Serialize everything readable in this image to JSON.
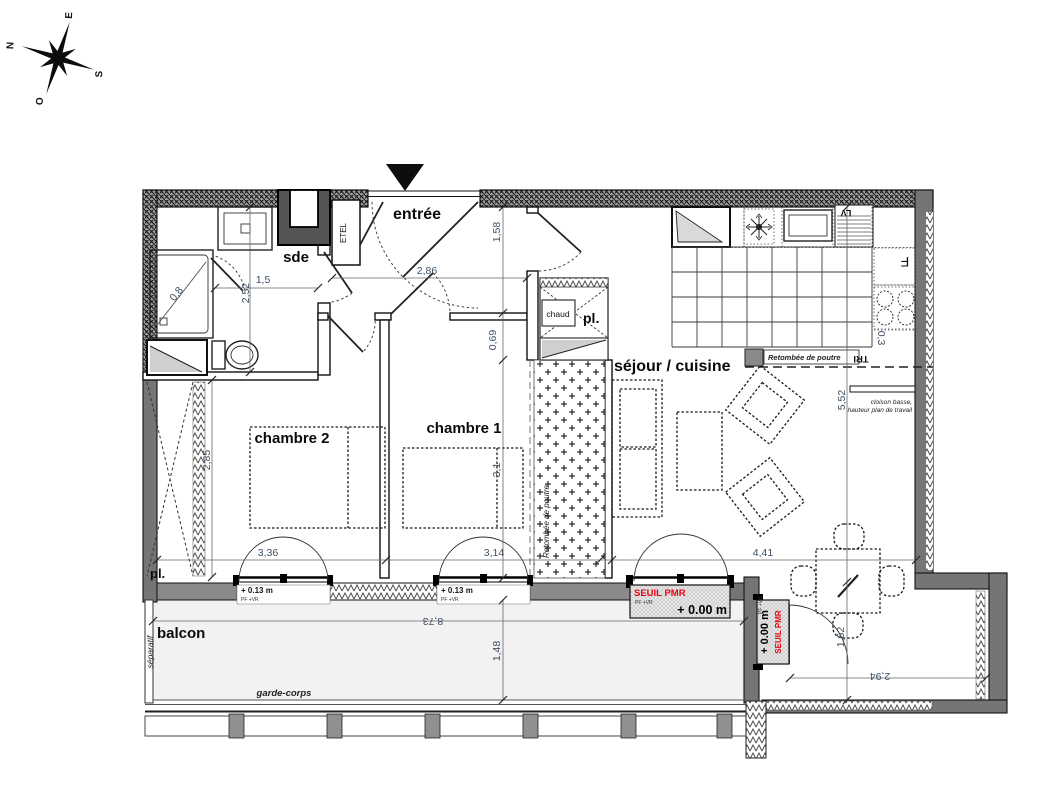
{
  "compass": {
    "n": "N",
    "e": "E",
    "s": "S",
    "o": "O"
  },
  "labels": {
    "entree": "entrée",
    "sde": "sde",
    "chambre1": "chambre 1",
    "chambre2": "chambre 2",
    "sejour": "séjour / cuisine",
    "balcon": "balcon",
    "pl": "pl.",
    "chaud": "chaud",
    "etel": "ETEL",
    "lv": "LV",
    "fridge": "F",
    "tri": "TRI"
  },
  "annotations": {
    "retombee": "Retombée de poutre",
    "cloison_line1": "cloison basse,",
    "cloison_line2": "hauteur plan de travail",
    "separatif": "séparatif",
    "garde_corps": "garde-corps",
    "seuil_pmr": "SEUIL PMR",
    "pf_vr": "PF +VR",
    "level_0": "+ 0.00 m",
    "level_13": "+ 0.13 m"
  },
  "dimensions": {
    "sde_height": "2,52",
    "sde_width": "1,5",
    "entree_width": "2,86",
    "entree_depth": "1,58",
    "beam_offset": "0,69",
    "chambre1_height": "3,1",
    "chambre2_height": "2,85",
    "chambre2_width": "3,36",
    "chambre1_width": "3,14",
    "sejour_width": "4,41",
    "sejour_height": "5,52",
    "balcon_width": "8,73",
    "balcon_depth": "1,48",
    "nook_depth": "1,62",
    "nook_width": "2,94",
    "shower": "0,8",
    "kitchen_return": "0,3"
  },
  "colors": {
    "accent_red": "#e30613",
    "wall_gray": "#757575",
    "dim_text": "#3d4f63"
  }
}
